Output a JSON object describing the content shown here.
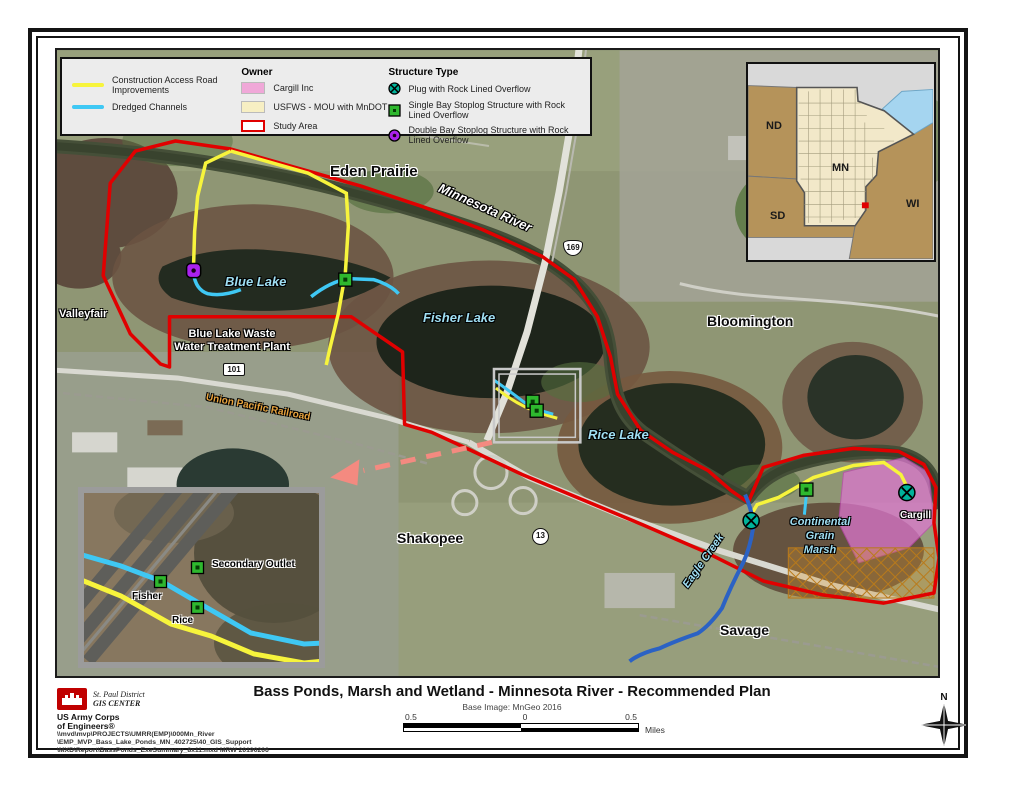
{
  "colors": {
    "study_area_red": "#e00000",
    "construction_yellow": "#f7f43c",
    "dredged_cyan": "#3fc8f4",
    "cargill_pink": "#f0a8d8",
    "usfws_yellow": "#f7efc3",
    "plug_teal": "#00b39b",
    "single_bay_green": "#2eb82e",
    "double_bay_purple": "#aa22ee",
    "eagle_creek_blue": "#2b62c4",
    "callout_arrow_pink": "#f48a80"
  },
  "legend": {
    "lines": [
      {
        "label": "Construction Access Road Improvements"
      },
      {
        "label": "Dredged Channels"
      }
    ],
    "owner_title": "Owner",
    "owner": [
      {
        "label": "Cargill Inc"
      },
      {
        "label": "USFWS - MOU with MnDOT"
      },
      {
        "label": "Study Area"
      }
    ],
    "structure_title": "Structure Type",
    "structures": [
      {
        "label": "Plug with Rock Lined Overflow"
      },
      {
        "label": "Single Bay Stoplog Structure with Rock Lined Overflow"
      },
      {
        "label": "Double Bay Stoplog Structure with Rock Lined Overflow"
      }
    ]
  },
  "map_labels": {
    "eden_prairie": "Eden Prairie",
    "minnesota_river": "Minnesota River",
    "blue_lake": "Blue Lake",
    "fisher_lake": "Fisher Lake",
    "rice_lake": "Rice Lake",
    "valleyfair": "Valleyfair",
    "wwtp": "Blue Lake Waste\nWater Treatment Plant",
    "union_pacific": "Union Pacific Railroad",
    "bloomington": "Bloomington",
    "shakopee": "Shakopee",
    "savage": "Savage",
    "eagle_creek": "Eagle Creek",
    "continental_grain_marsh": "Continental\nGrain\nMarsh",
    "cargill": "Cargill",
    "hwy_101": "101",
    "hwy_169": "169",
    "hwy_13": "13"
  },
  "detail_inset": {
    "secondary_outlet": "Secondary Outlet",
    "fisher": "Fisher",
    "rice": "Rice"
  },
  "inset_map": {
    "nd": "ND",
    "mn": "MN",
    "sd": "SD",
    "wi": "WI"
  },
  "footer": {
    "title": "Bass Ponds, Marsh and Wetland - Minnesota River - Recommended Plan",
    "base_image": "Base Image: MnGeo 2016",
    "district": "St. Paul District",
    "gis_center": "GIS CENTER",
    "corps_line1": "US Army Corps",
    "corps_line2": "of Engineers®",
    "path_line1": "\\\\mvd\\mvp\\PROJECTS\\UMRR(EMP)\\000Mn_River",
    "path_line2": "\\EMP_MVP_Bass_Lake_Ponds_MN_402725\\40_GIS_Support",
    "path_line3": "\\MXD\\Report\\BassPonds_ExeSummary_8x11.mxd MRW 20190206",
    "scale": {
      "tick_left": "0.5",
      "tick_mid": "0",
      "tick_right": "0.5",
      "unit": "Miles"
    },
    "north_label": "N"
  }
}
